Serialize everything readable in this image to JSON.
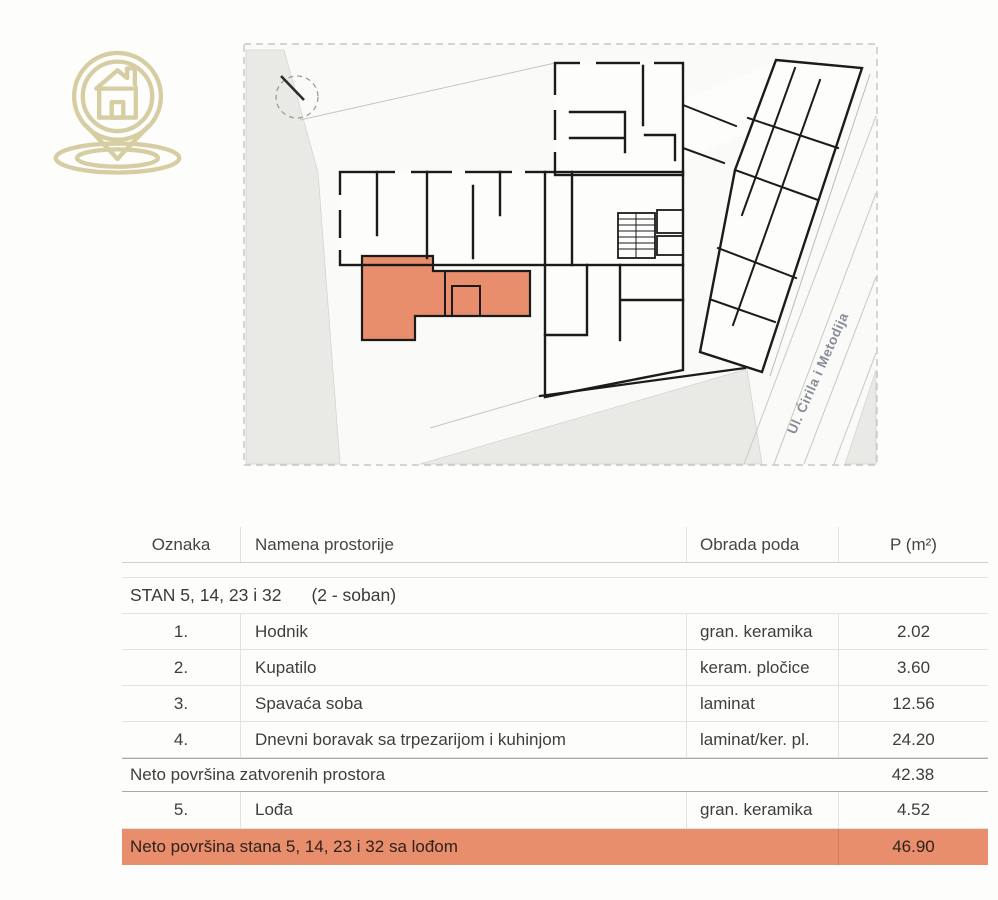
{
  "logo": {
    "icon": "house-location-pin-icon",
    "color": "#d7cda3"
  },
  "plan": {
    "street_label": "Ul. Ćirila i Metodija",
    "north_indicator": "north-arrow",
    "highlight_color": "#e98e6c"
  },
  "table": {
    "headers": {
      "oznaka": "Oznaka",
      "namena": "Namena prostorije",
      "obrada": "Obrada poda",
      "p": "P (m²)"
    },
    "section": {
      "title": "STAN 5, 14, 23 i 32",
      "subtitle": "(2 - soban)"
    },
    "rows": [
      {
        "num": "1.",
        "name": "Hodnik",
        "floor": "gran. keramika",
        "area": "2.02"
      },
      {
        "num": "2.",
        "name": "Kupatilo",
        "floor": "keram. pločice",
        "area": "3.60"
      },
      {
        "num": "3.",
        "name": "Spavaća soba",
        "floor": "laminat",
        "area": "12.56"
      },
      {
        "num": "4.",
        "name": "Dnevni boravak sa trpezarijom i kuhinjom",
        "floor": "laminat/ker. pl.",
        "area": "24.20"
      }
    ],
    "subtotal": {
      "label": "Neto površina zatvorenih prostora",
      "area": "42.38"
    },
    "loggia": {
      "num": "5.",
      "name": "Lođa",
      "floor": "gran. keramika",
      "area": "4.52"
    },
    "total": {
      "label": "Neto površina stana 5, 14, 23 i 32 sa lođom",
      "area": "46.90"
    }
  }
}
